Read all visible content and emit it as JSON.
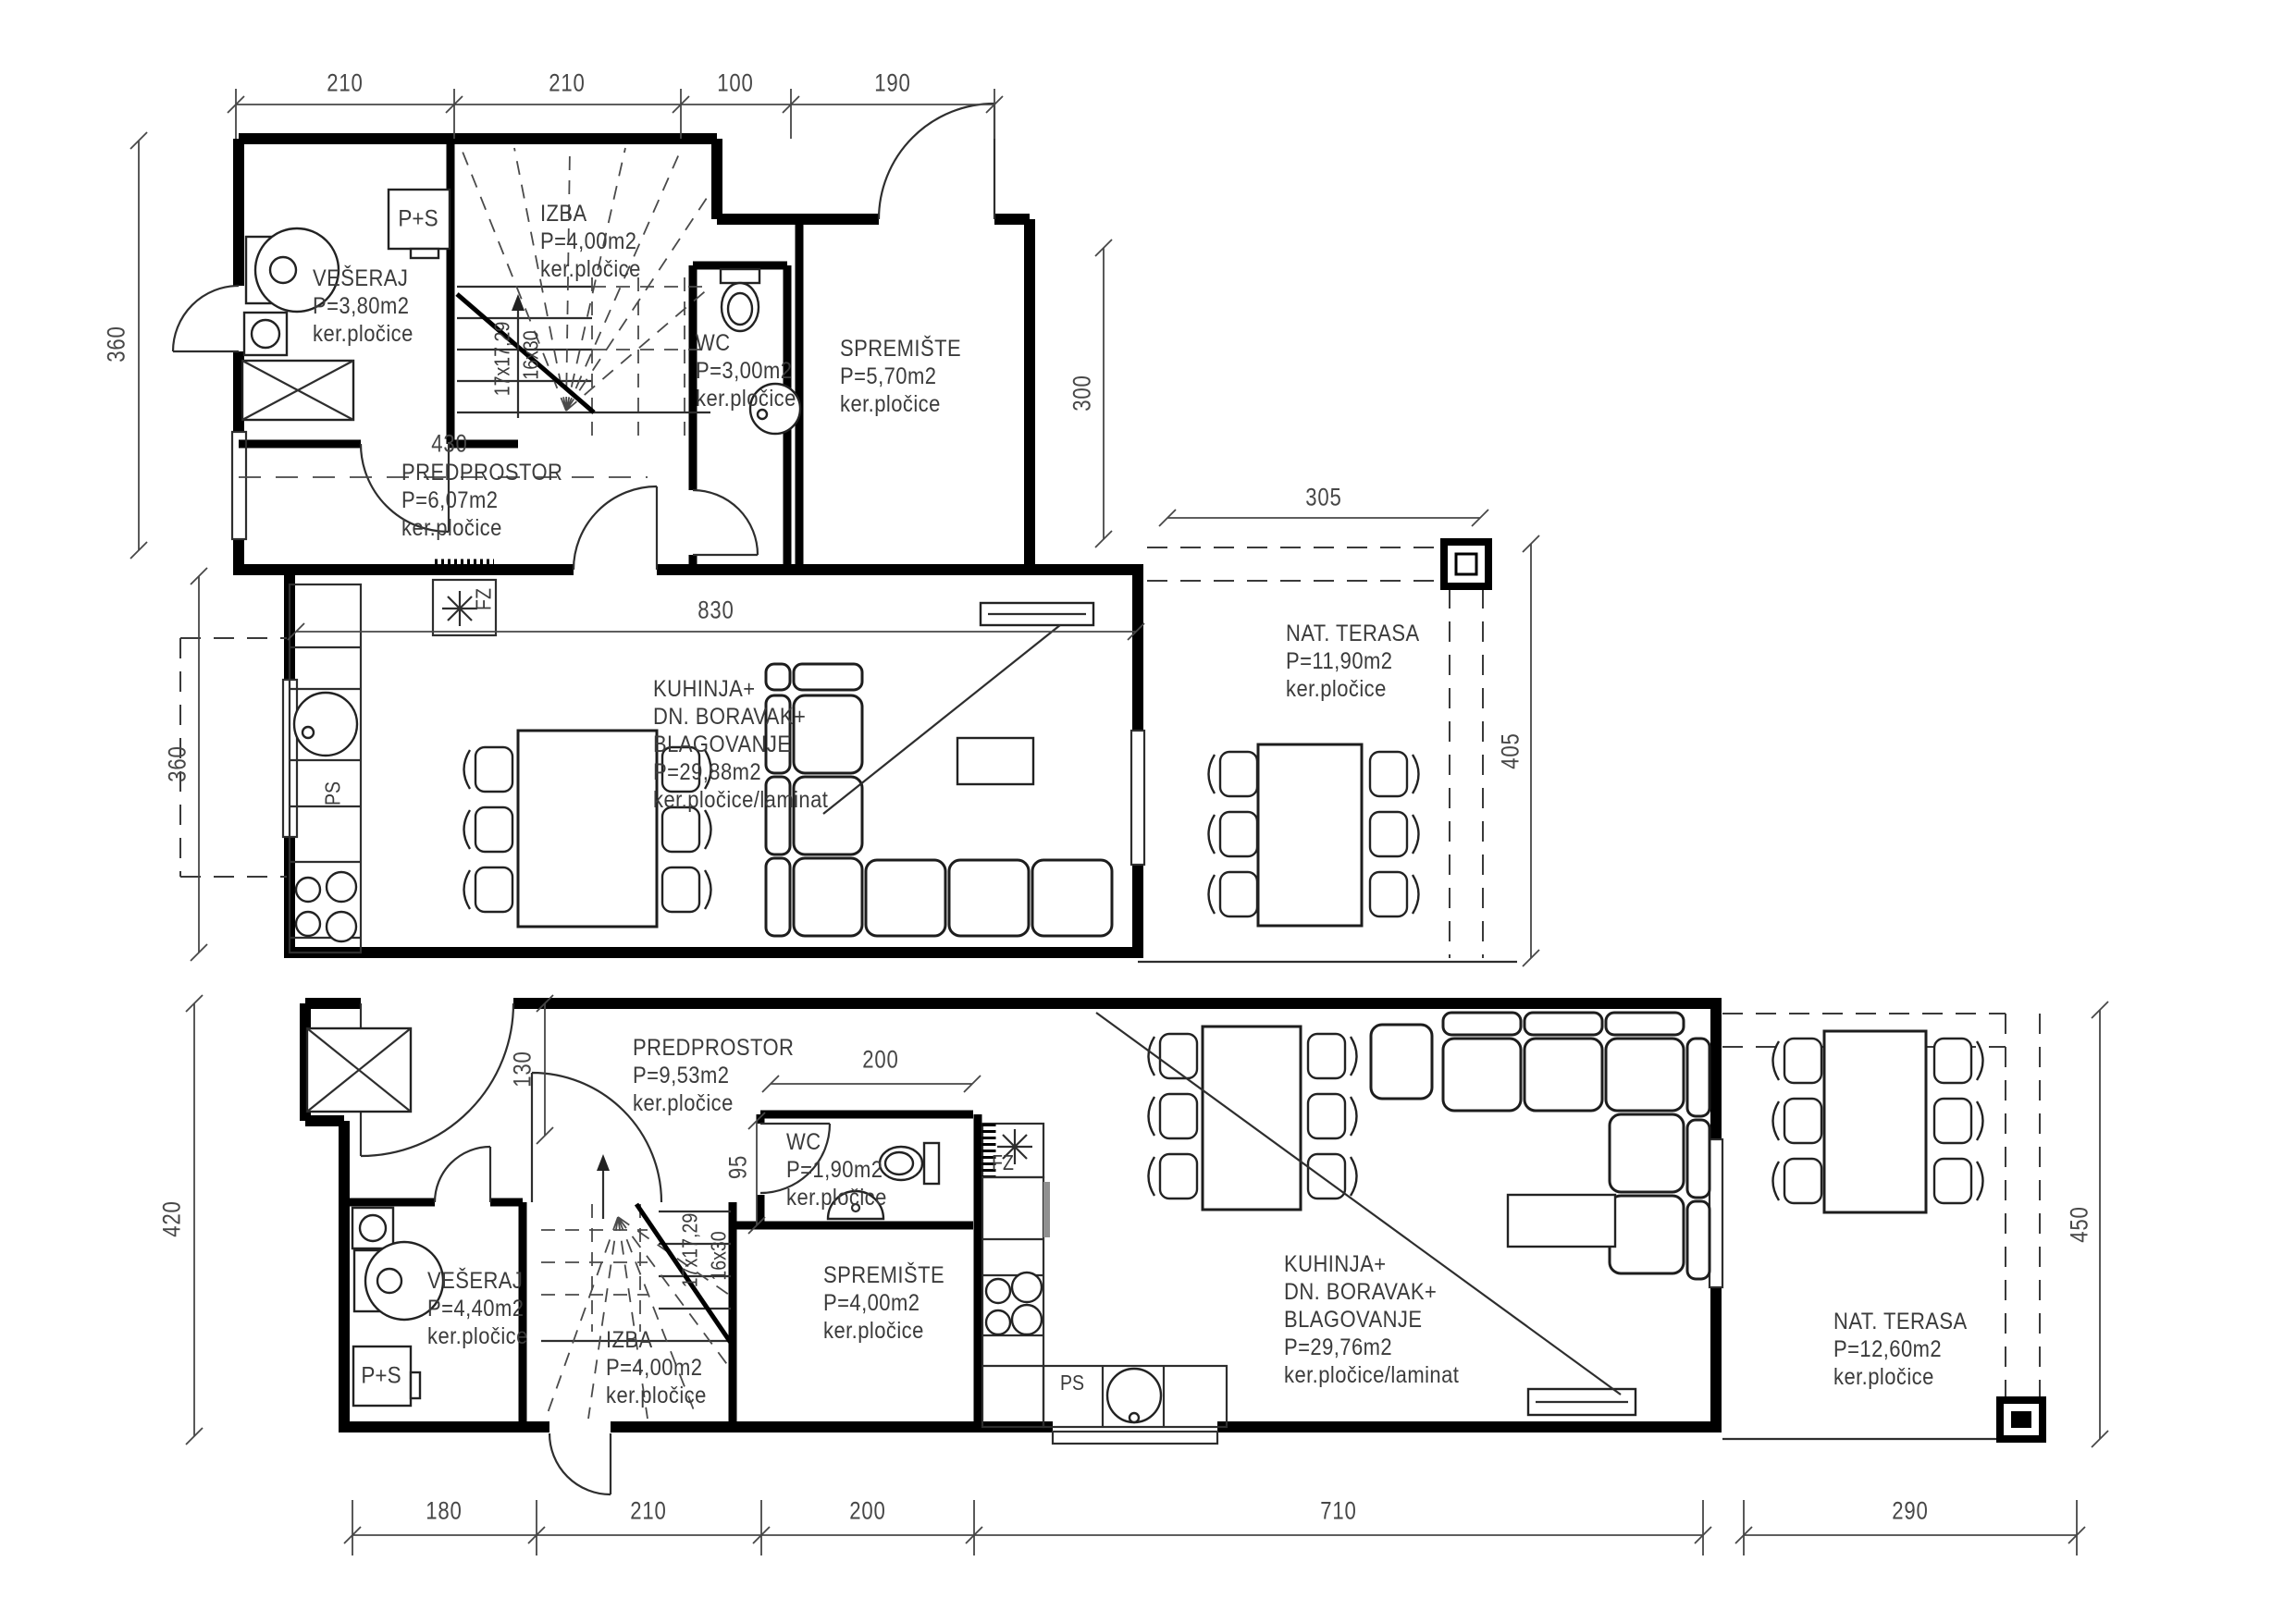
{
  "appliances": {
    "boiler": "P+S",
    "freezer": "FZ",
    "dishwasher": "PS"
  },
  "stairs": {
    "risers": "17x17,29",
    "treads": "16x30"
  },
  "rooms_upper": {
    "veseraj": [
      "VEŠERAJ",
      "P=3,80m2",
      "ker.pločice"
    ],
    "izba": [
      "IZBA",
      "P=4,00m2",
      "ker.pločice"
    ],
    "wc": [
      "WC",
      "P=3,00m2",
      "ker.pločice"
    ],
    "spremiste": [
      "SPREMIŠTE",
      "P=5,70m2",
      "ker.pločice"
    ],
    "predprostor": [
      "PREDPROSTOR",
      "P=6,07m2",
      "ker.pločice"
    ],
    "kuhinja": [
      "KUHINJA+",
      "DN. BORAVAK+",
      "BLAGOVANJE",
      "P=29,88m2",
      "ker.pločice/laminat"
    ],
    "terasa": [
      "NAT. TERASA",
      "P=11,90m2",
      "ker.pločice"
    ]
  },
  "rooms_lower": {
    "predprostor": [
      "PREDPROSTOR",
      "P=9,53m2",
      "ker.pločice"
    ],
    "wc": [
      "WC",
      "P=1,90m2",
      "ker.pločice"
    ],
    "veseraj": [
      "VEŠERAJ",
      "P=4,40m2",
      "ker.pločice"
    ],
    "izba": [
      "IZBA",
      "P=4,00m2",
      "ker.pločice"
    ],
    "spremiste": [
      "SPREMIŠTE",
      "P=4,00m2",
      "ker.pločice"
    ],
    "kuhinja": [
      "KUHINJA+",
      "DN. BORAVAK+",
      "BLAGOVANJE",
      "P=29,76m2",
      "ker.pločice/laminat"
    ],
    "terasa": [
      "NAT. TERASA",
      "P=12,60m2",
      "ker.pločice"
    ]
  },
  "dims_upper": {
    "top": [
      "210",
      "210",
      "100",
      "190"
    ],
    "left_upper": "360",
    "left_lower": "360",
    "right": "300",
    "interior_width": "830",
    "hall_width": "430",
    "terrace_width": "305",
    "terrace_depth": "405"
  },
  "dims_lower": {
    "left": "420",
    "entry_offset": "130",
    "wc_width": "200",
    "wc_depth": "95",
    "bottom": [
      "180",
      "210",
      "200",
      "710",
      "290"
    ],
    "terrace_depth": "450"
  }
}
